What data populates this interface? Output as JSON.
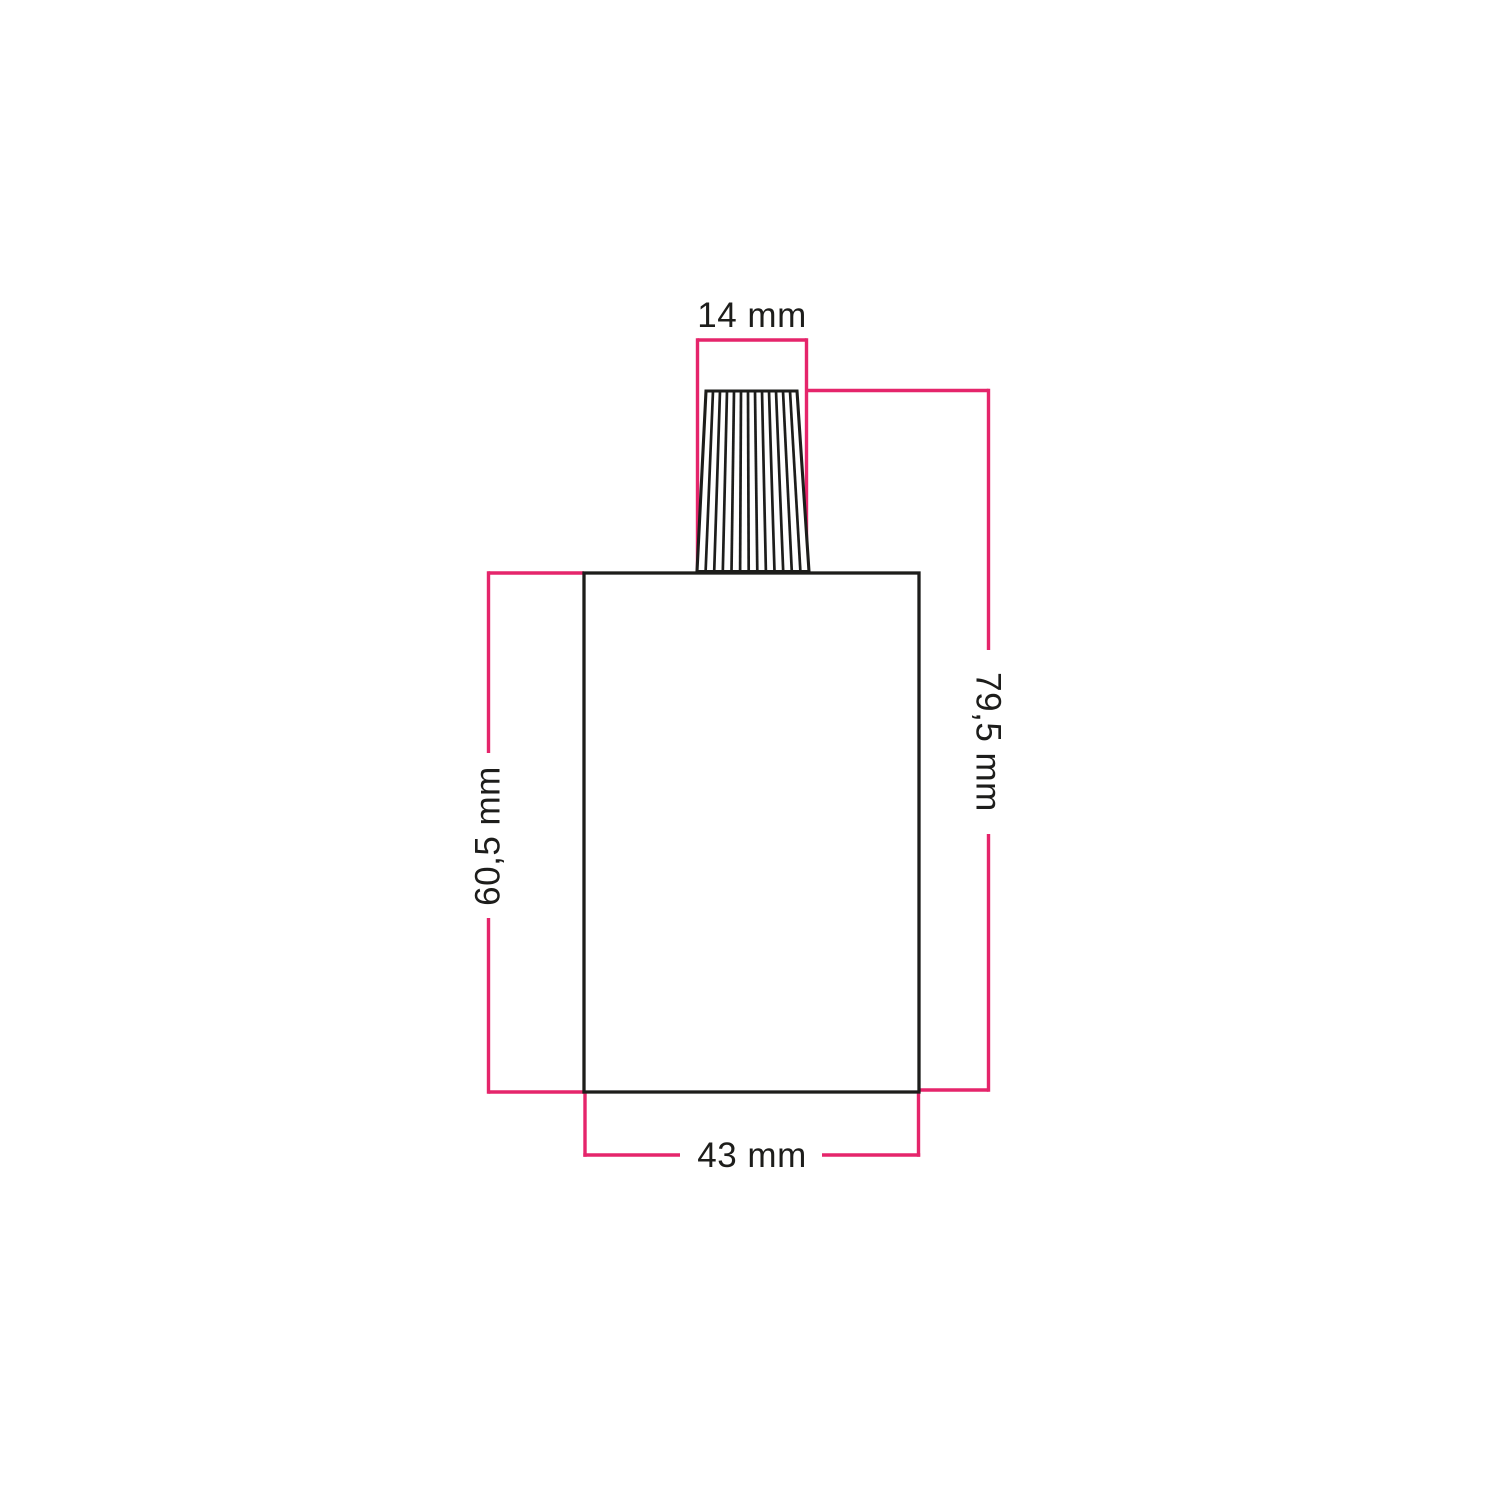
{
  "drawing": {
    "description": "technical-dimension-drawing-of-cylindrical-lamp-holder-with-ribbed-cable-gland",
    "labels": {
      "gland_top_width": "14 mm",
      "total_height": "79,5 mm",
      "body_height": "60,5 mm",
      "body_width": "43 mm"
    },
    "colors": {
      "dimension_line_pink": "#e5256b",
      "outline_black": "#1d1d1b",
      "background_white": "#ffffff"
    }
  }
}
